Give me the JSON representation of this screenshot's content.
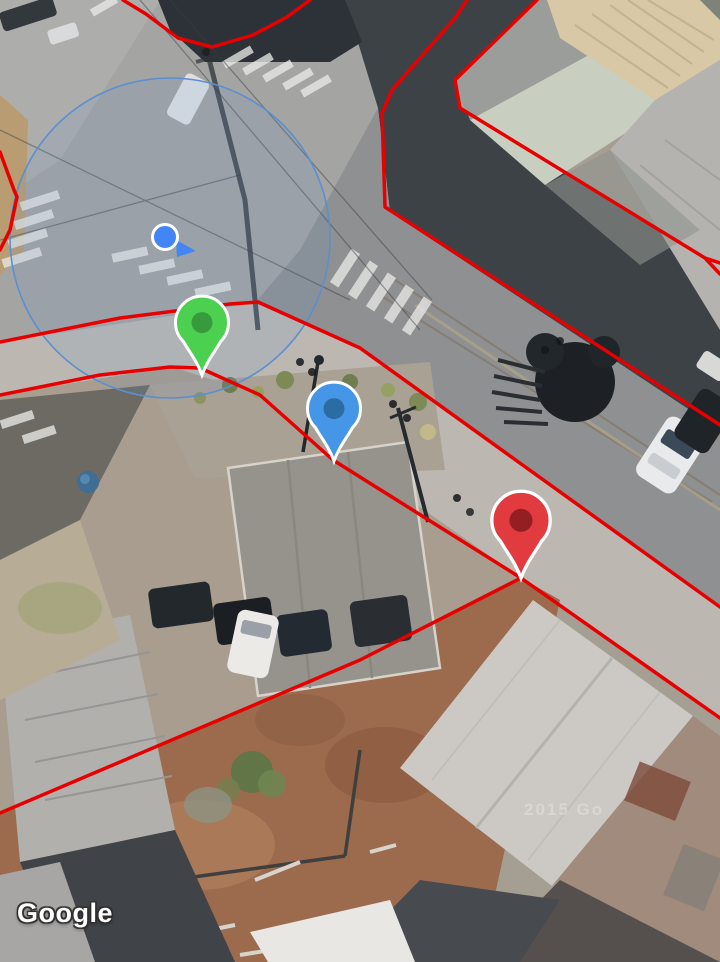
{
  "map": {
    "provider_watermark": "Google",
    "imagery_watermark": "2015 Go",
    "boundary_line_color": "#E60000"
  },
  "location_indicator": {
    "dot_color": "#4285F4",
    "ring_color": "#FFFFFF",
    "accuracy_fill": "rgba(96,148,214,0.13)",
    "accuracy_stroke": "#5B8FD0"
  },
  "markers": [
    {
      "id": "green",
      "fill": "#4CD04F",
      "dot": "#379A3D",
      "outline": "#FFFFFF"
    },
    {
      "id": "blue",
      "fill": "#4596E6",
      "dot": "#2B6CA4",
      "outline": "#FFFFFF"
    },
    {
      "id": "red",
      "fill": "#E23B3F",
      "dot": "#941F22",
      "outline": "#FFFFFF"
    }
  ]
}
